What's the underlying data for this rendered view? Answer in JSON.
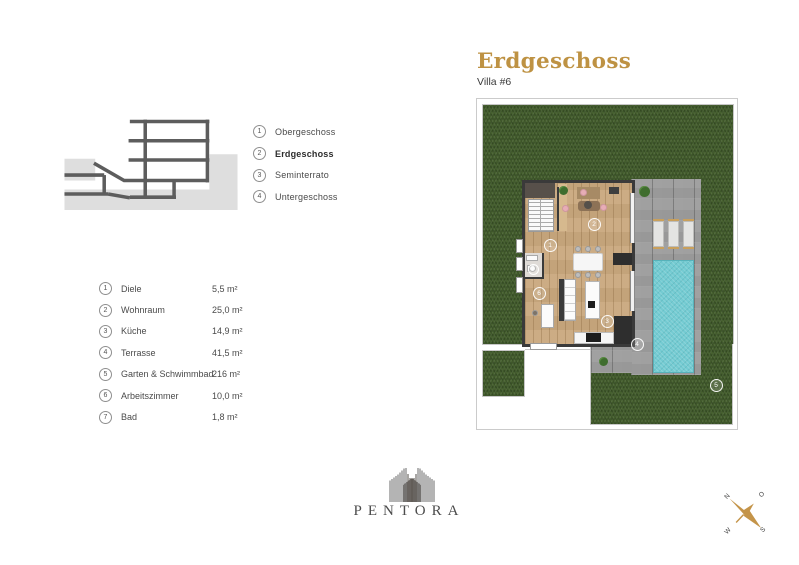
{
  "header": {
    "title": "Erdgeschoss",
    "subtitle": "Villa #6"
  },
  "floor_nav": [
    {
      "num": "1",
      "label": "Obergeschoss",
      "active": false
    },
    {
      "num": "2",
      "label": "Erdgeschoss",
      "active": true
    },
    {
      "num": "3",
      "label": "Seminterrato",
      "active": false
    },
    {
      "num": "4",
      "label": "Untergeschoss",
      "active": false
    }
  ],
  "rooms": [
    {
      "num": "1",
      "name": "Diele",
      "area": "5,5 m²"
    },
    {
      "num": "2",
      "name": "Wohnraum",
      "area": "25,0 m²"
    },
    {
      "num": "3",
      "name": "Küche",
      "area": "14,9 m²"
    },
    {
      "num": "4",
      "name": "Terrasse",
      "area": "41,5 m²"
    },
    {
      "num": "5",
      "name": "Garten & Schwimmbad",
      "area": "216 m²"
    },
    {
      "num": "6",
      "name": "Arbeitszimmer",
      "area": "10,0 m²"
    },
    {
      "num": "7",
      "name": "Bad",
      "area": "1,8 m²"
    }
  ],
  "plan": {
    "markers": [
      "1",
      "2",
      "3",
      "4",
      "5",
      "6",
      "7"
    ]
  },
  "brand": {
    "name": "PENTORA"
  },
  "compass": {
    "n": "N",
    "e": "O",
    "s": "S",
    "w": "W"
  },
  "colors": {
    "accent": "#BE9243",
    "grass": "#46602F",
    "terrace": "#A0A0A0",
    "pool": "#74CBD2",
    "wood": "#C9A87E",
    "wall": "#3A3A3A",
    "compass_needle": "#C49449"
  }
}
